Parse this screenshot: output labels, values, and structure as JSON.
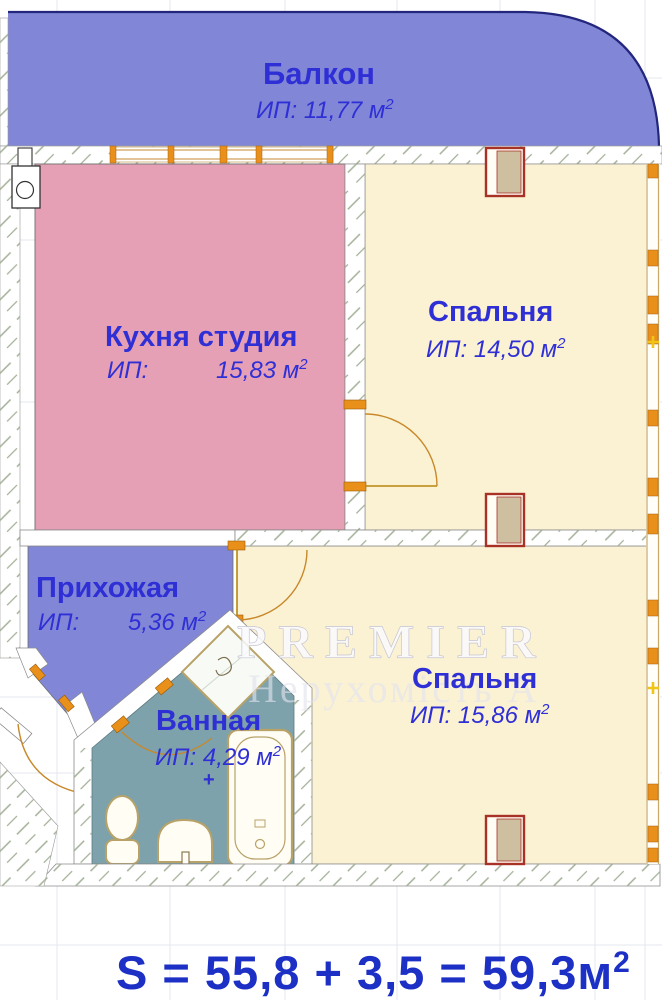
{
  "rooms": {
    "balcony": {
      "label": "Балкон",
      "area": "ИП: 11,77 м",
      "area_sup": "2"
    },
    "kitchen": {
      "label": "Кухня студия",
      "area_key": "ИП:",
      "area_value": "15,83 м",
      "area_sup": "2"
    },
    "bedroom_top": {
      "label": "Спальня",
      "area": "ИП: 14,50 м",
      "area_sup": "2"
    },
    "hallway": {
      "label": "Прихожая",
      "area_key": "ИП:",
      "area_value": "5,36 м",
      "area_sup": "2"
    },
    "bathroom": {
      "label": "Ванная",
      "area": "ИП: 4,29 м",
      "area_sup": "2",
      "plus_mark": "+"
    },
    "bedroom_bottom": {
      "label": "Спальня",
      "area": "ИП: 15,86 м",
      "area_sup": "2"
    }
  },
  "watermark": {
    "line1": "PREMIER",
    "line2": "Нерухомість А"
  },
  "total_area": {
    "formula": "S = 55,8 + 3,5 = 59,3м",
    "sup": "2"
  },
  "colors": {
    "balcony_fill": "#8187d6",
    "hallway_fill": "#8187d6",
    "kitchen_fill": "#e6a0b5",
    "bedroom_fill": "#fbf2d4",
    "bathroom_fill": "#7da2ab",
    "label_text": "#2f2fd6",
    "total_text": "#1d30c5",
    "window_frame": "#e8901a",
    "radiator_border": "#a93226",
    "radiator_fill": "#cdbfa0",
    "hatch_line": "#a3b098",
    "balcony_outline": "#23267d",
    "fixture_outline": "#b8a268"
  }
}
